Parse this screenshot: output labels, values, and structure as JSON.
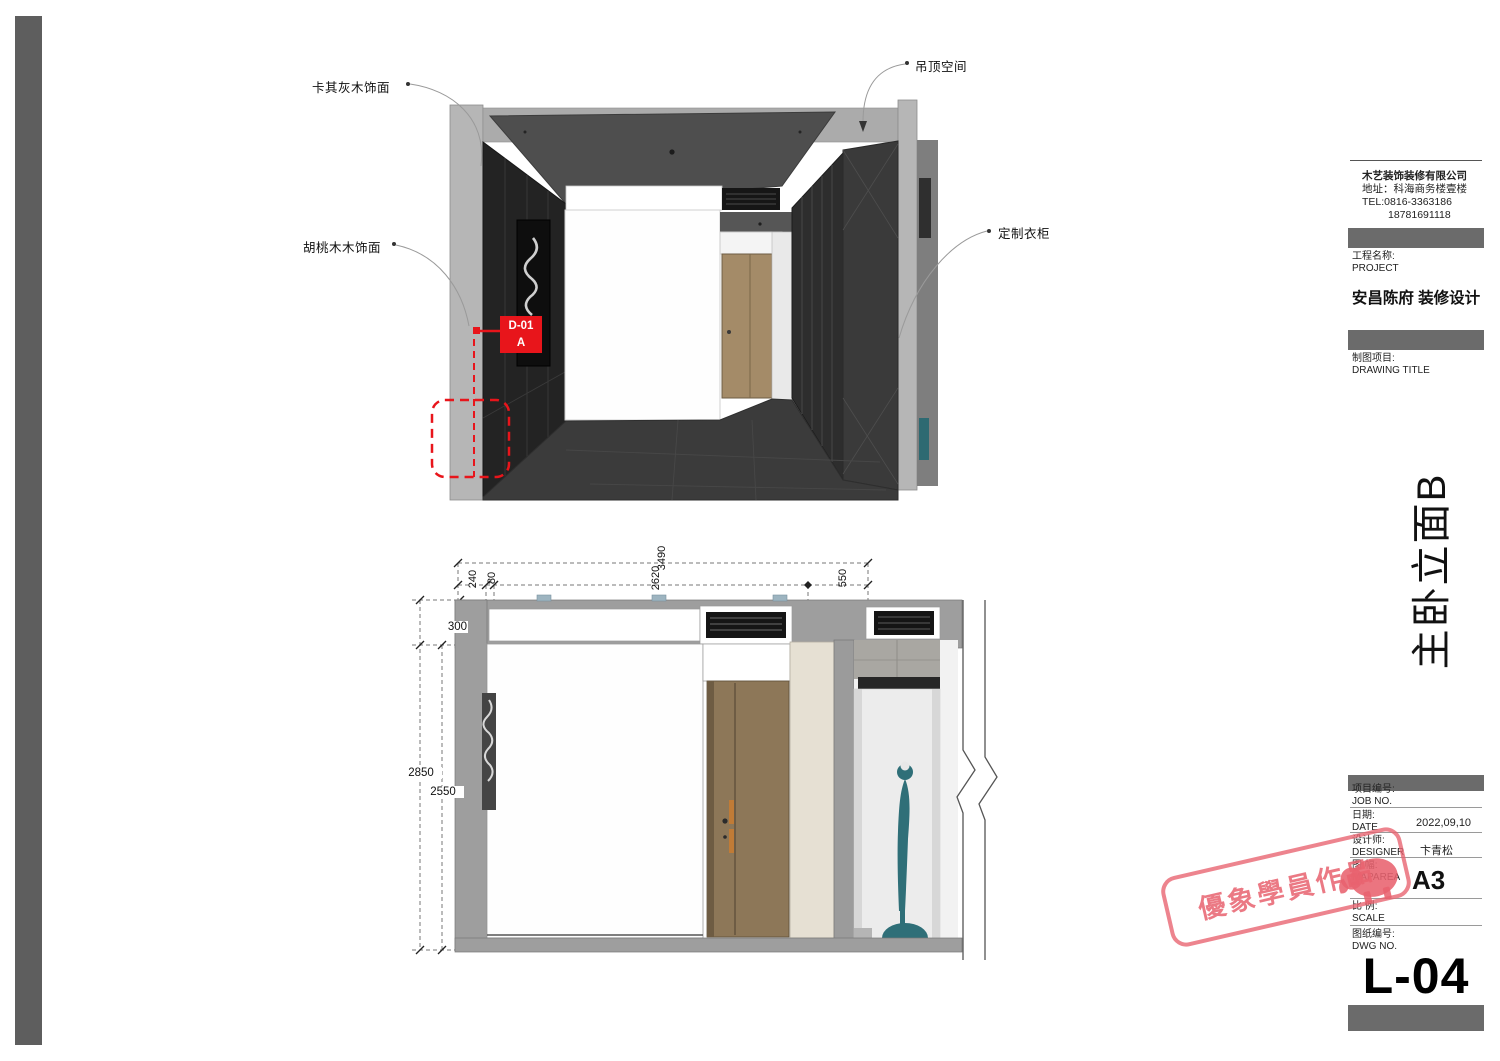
{
  "sheet": {
    "code": "L-04",
    "project_name": "安昌陈府 装修设计",
    "drawing_title": "主卧立面B"
  },
  "company": {
    "name": "木艺装饰装修有限公司",
    "address": "地址：科海商务楼壹楼",
    "tel": "TEL:0816-3363186",
    "tel2": "18781691118"
  },
  "titleblock": {
    "project_label_cn": "工程名称:",
    "project_label_en": "PROJECT",
    "drawing_label_cn": "制图项目:",
    "drawing_label_en": "DRAWING TITLE",
    "rows": [
      {
        "cn": "项目编号:",
        "en": "JOB NO.",
        "value": ""
      },
      {
        "cn": "日期:",
        "en": "DATE",
        "value": "2022,09,10"
      },
      {
        "cn": "设计师:",
        "en": "DESIGNER",
        "value": "卞青松"
      },
      {
        "cn": "图 幅:",
        "en": "MAPAREA",
        "value": "A3"
      },
      {
        "cn": "比 例:",
        "en": "SCALE",
        "value": ""
      },
      {
        "cn": "图纸编号:",
        "en": "DWG NO.",
        "value": ""
      }
    ]
  },
  "annotations": {
    "finish_top": "卡其灰木饰面",
    "ceiling": "吊顶空间",
    "finish_mid": "胡桃木木饰面",
    "wardrobe": "定制衣柜",
    "detail_code": "D-01",
    "detail_sub": "A"
  },
  "dimensions": {
    "total_width": "3490",
    "seg1": "240",
    "seg2": "80",
    "seg3": "2620",
    "seg4": "550",
    "drop": "300",
    "total_height": "2850",
    "clear_height": "2550"
  },
  "stamp": {
    "text": "優象學員作品"
  },
  "colors": {
    "marker_red": "#e8151b",
    "stamp_pink": "#e8626e",
    "door_wood": "#9a825f",
    "mannequin_teal": "#2f6f78",
    "bar_gray": "#6b6b6b"
  }
}
